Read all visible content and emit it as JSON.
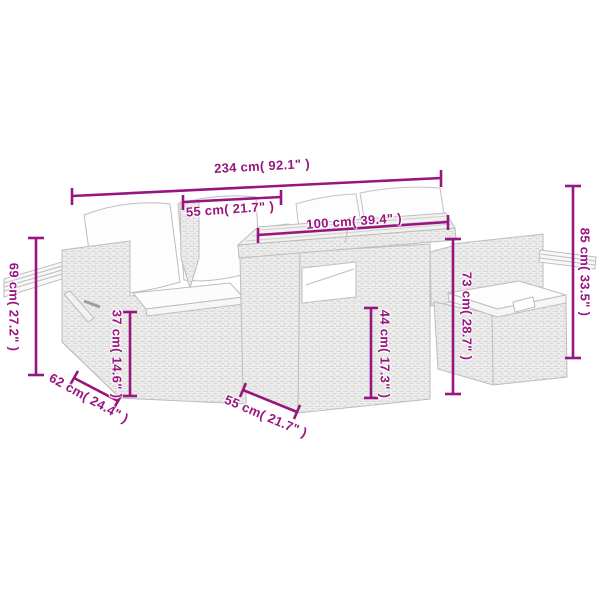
{
  "figure": {
    "type": "product-dimension-diagram",
    "background_color": "#ffffff",
    "accent_color": "#981580",
    "line_color": "#bdbdbd"
  },
  "dimensions": [
    {
      "id": "overall-width",
      "label": "234 cm( 92.1\" )"
    },
    {
      "id": "seat-width",
      "label": "55 cm( 21.7\" )"
    },
    {
      "id": "tabletop-width",
      "label": "100 cm( 39.4\" )"
    },
    {
      "id": "overall-height",
      "label": "85 cm( 33.5\" )"
    },
    {
      "id": "arm-shelf-height",
      "label": "69 cm( 27.2\" )"
    },
    {
      "id": "seat-height",
      "label": "37 cm( 14.6\" )"
    },
    {
      "id": "table-body-height",
      "label": "44 cm( 17.3\" )"
    },
    {
      "id": "table-height",
      "label": "73 cm( 28.7\" )"
    },
    {
      "id": "seat-depth",
      "label": "62 cm( 24.4\" )"
    },
    {
      "id": "table-depth",
      "label": "55 cm( 21.7\" )"
    }
  ],
  "furniture": {
    "parts": [
      "left-sofa-with-cushions",
      "flip-up-side-shelf",
      "corner-back-cushions",
      "storage-table",
      "ottoman-with-cushion",
      "right-side-shelf"
    ]
  }
}
